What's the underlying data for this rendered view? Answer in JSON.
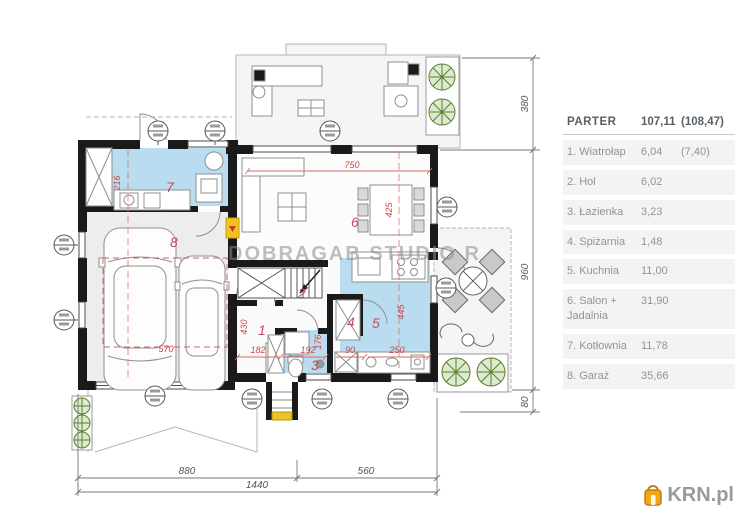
{
  "watermark": "DOBRAGAB STUDIO R",
  "logo": {
    "text": "KRN.pl"
  },
  "legend": {
    "title": "PARTER",
    "total": "107,11",
    "total_alt": "(108,47)",
    "rows": [
      {
        "label": "1. Wiatrołap",
        "area": "6,04",
        "extra": "(7,40)"
      },
      {
        "label": "2. Hol",
        "area": "6,02",
        "extra": ""
      },
      {
        "label": "3. Łazienka",
        "area": "3,23",
        "extra": ""
      },
      {
        "label": "4. Spiżarnia",
        "area": "1,48",
        "extra": ""
      },
      {
        "label": "5. Kuchnia",
        "area": "11,00",
        "extra": ""
      },
      {
        "label": "6. Salon + Jadalnia",
        "area": "31,90",
        "extra": ""
      },
      {
        "label": "7. Kotłownia",
        "area": "11,78",
        "extra": ""
      },
      {
        "label": "8. Garaż",
        "area": "35,66",
        "extra": ""
      }
    ]
  },
  "rooms": {
    "r1": "1",
    "r2": "2",
    "r3": "3",
    "r4": "4",
    "r5": "5",
    "r6": "6",
    "r7": "7",
    "r8": "8"
  },
  "dims": {
    "d216": "216",
    "d750": "750",
    "d425": "425",
    "d445": "445",
    "d250": "250",
    "d90": "90",
    "d176": "176",
    "d192": "192",
    "d182": "182",
    "d430": "430",
    "d570": "570",
    "b880": "880",
    "b560": "560",
    "b1440": "1440",
    "v380": "380",
    "v960": "960",
    "v80": "80"
  },
  "colors": {
    "wall": "#1a1a1a",
    "wet_room": "#badcf0",
    "dim_red": "#cb4a44",
    "room_label": "#c64a5e",
    "legend_row_bg": "#f3f3f3",
    "krn_orange": "#f2a71b"
  }
}
